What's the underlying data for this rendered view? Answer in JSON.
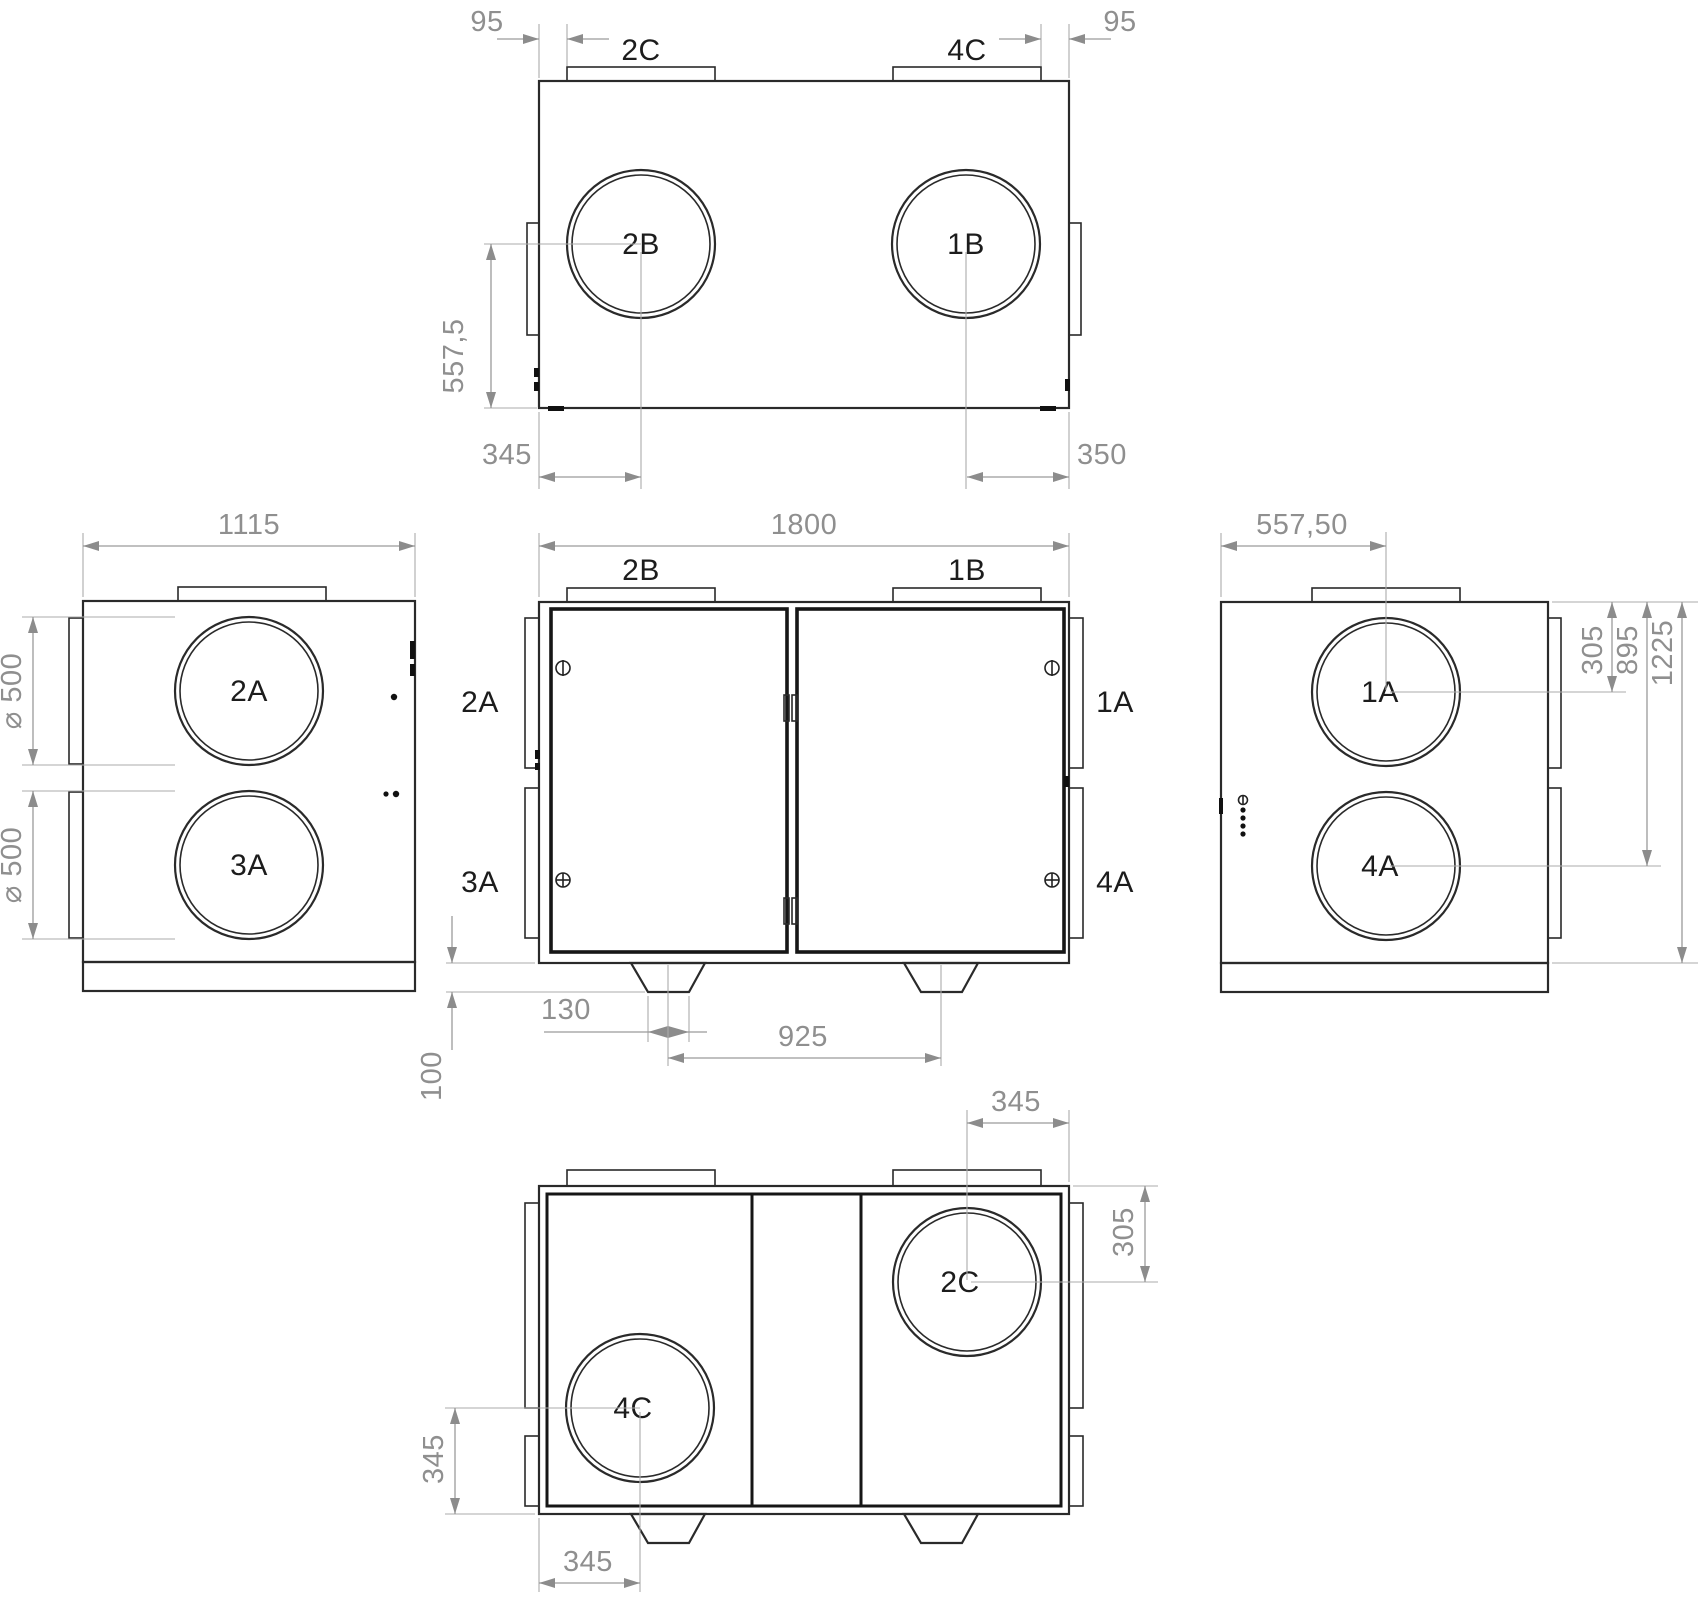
{
  "views": {
    "top": {
      "flange_left_label": "2C",
      "flange_right_label": "4C",
      "circle_left_label": "2B",
      "circle_right_label": "1B",
      "dim_inset_left": "95",
      "dim_inset_right": "95",
      "dim_circle_from_bottom": "557,5",
      "dim_circle_left": "345",
      "dim_circle_right": "350"
    },
    "left": {
      "circle_top_label": "2A",
      "circle_bottom_label": "3A",
      "dim_width": "1115",
      "dim_dia_top": "⌀ 500",
      "dim_dia_bottom": "⌀ 500"
    },
    "front": {
      "flange_left_label": "2B",
      "flange_right_label": "1B",
      "port_left_top": "2A",
      "port_left_bottom": "3A",
      "port_right_top": "1A",
      "port_right_bottom": "4A",
      "dim_width": "1800",
      "dim_foot_height": "100",
      "dim_foot_width": "130",
      "dim_foot_spacing": "925"
    },
    "right": {
      "circle_top_label": "1A",
      "circle_bottom_label": "4A",
      "dim_center": "557,50",
      "dim_top_circle": "305",
      "dim_bottom_circle": "895",
      "dim_height": "1225"
    },
    "bottom": {
      "circle_right_label": "2C",
      "circle_left_label": "4C",
      "dim_top": "345",
      "dim_right": "305",
      "dim_left": "345",
      "dim_bottom": "345"
    }
  },
  "colors": {
    "line": "#2a2a2a",
    "dim": "#9a9a9a"
  }
}
